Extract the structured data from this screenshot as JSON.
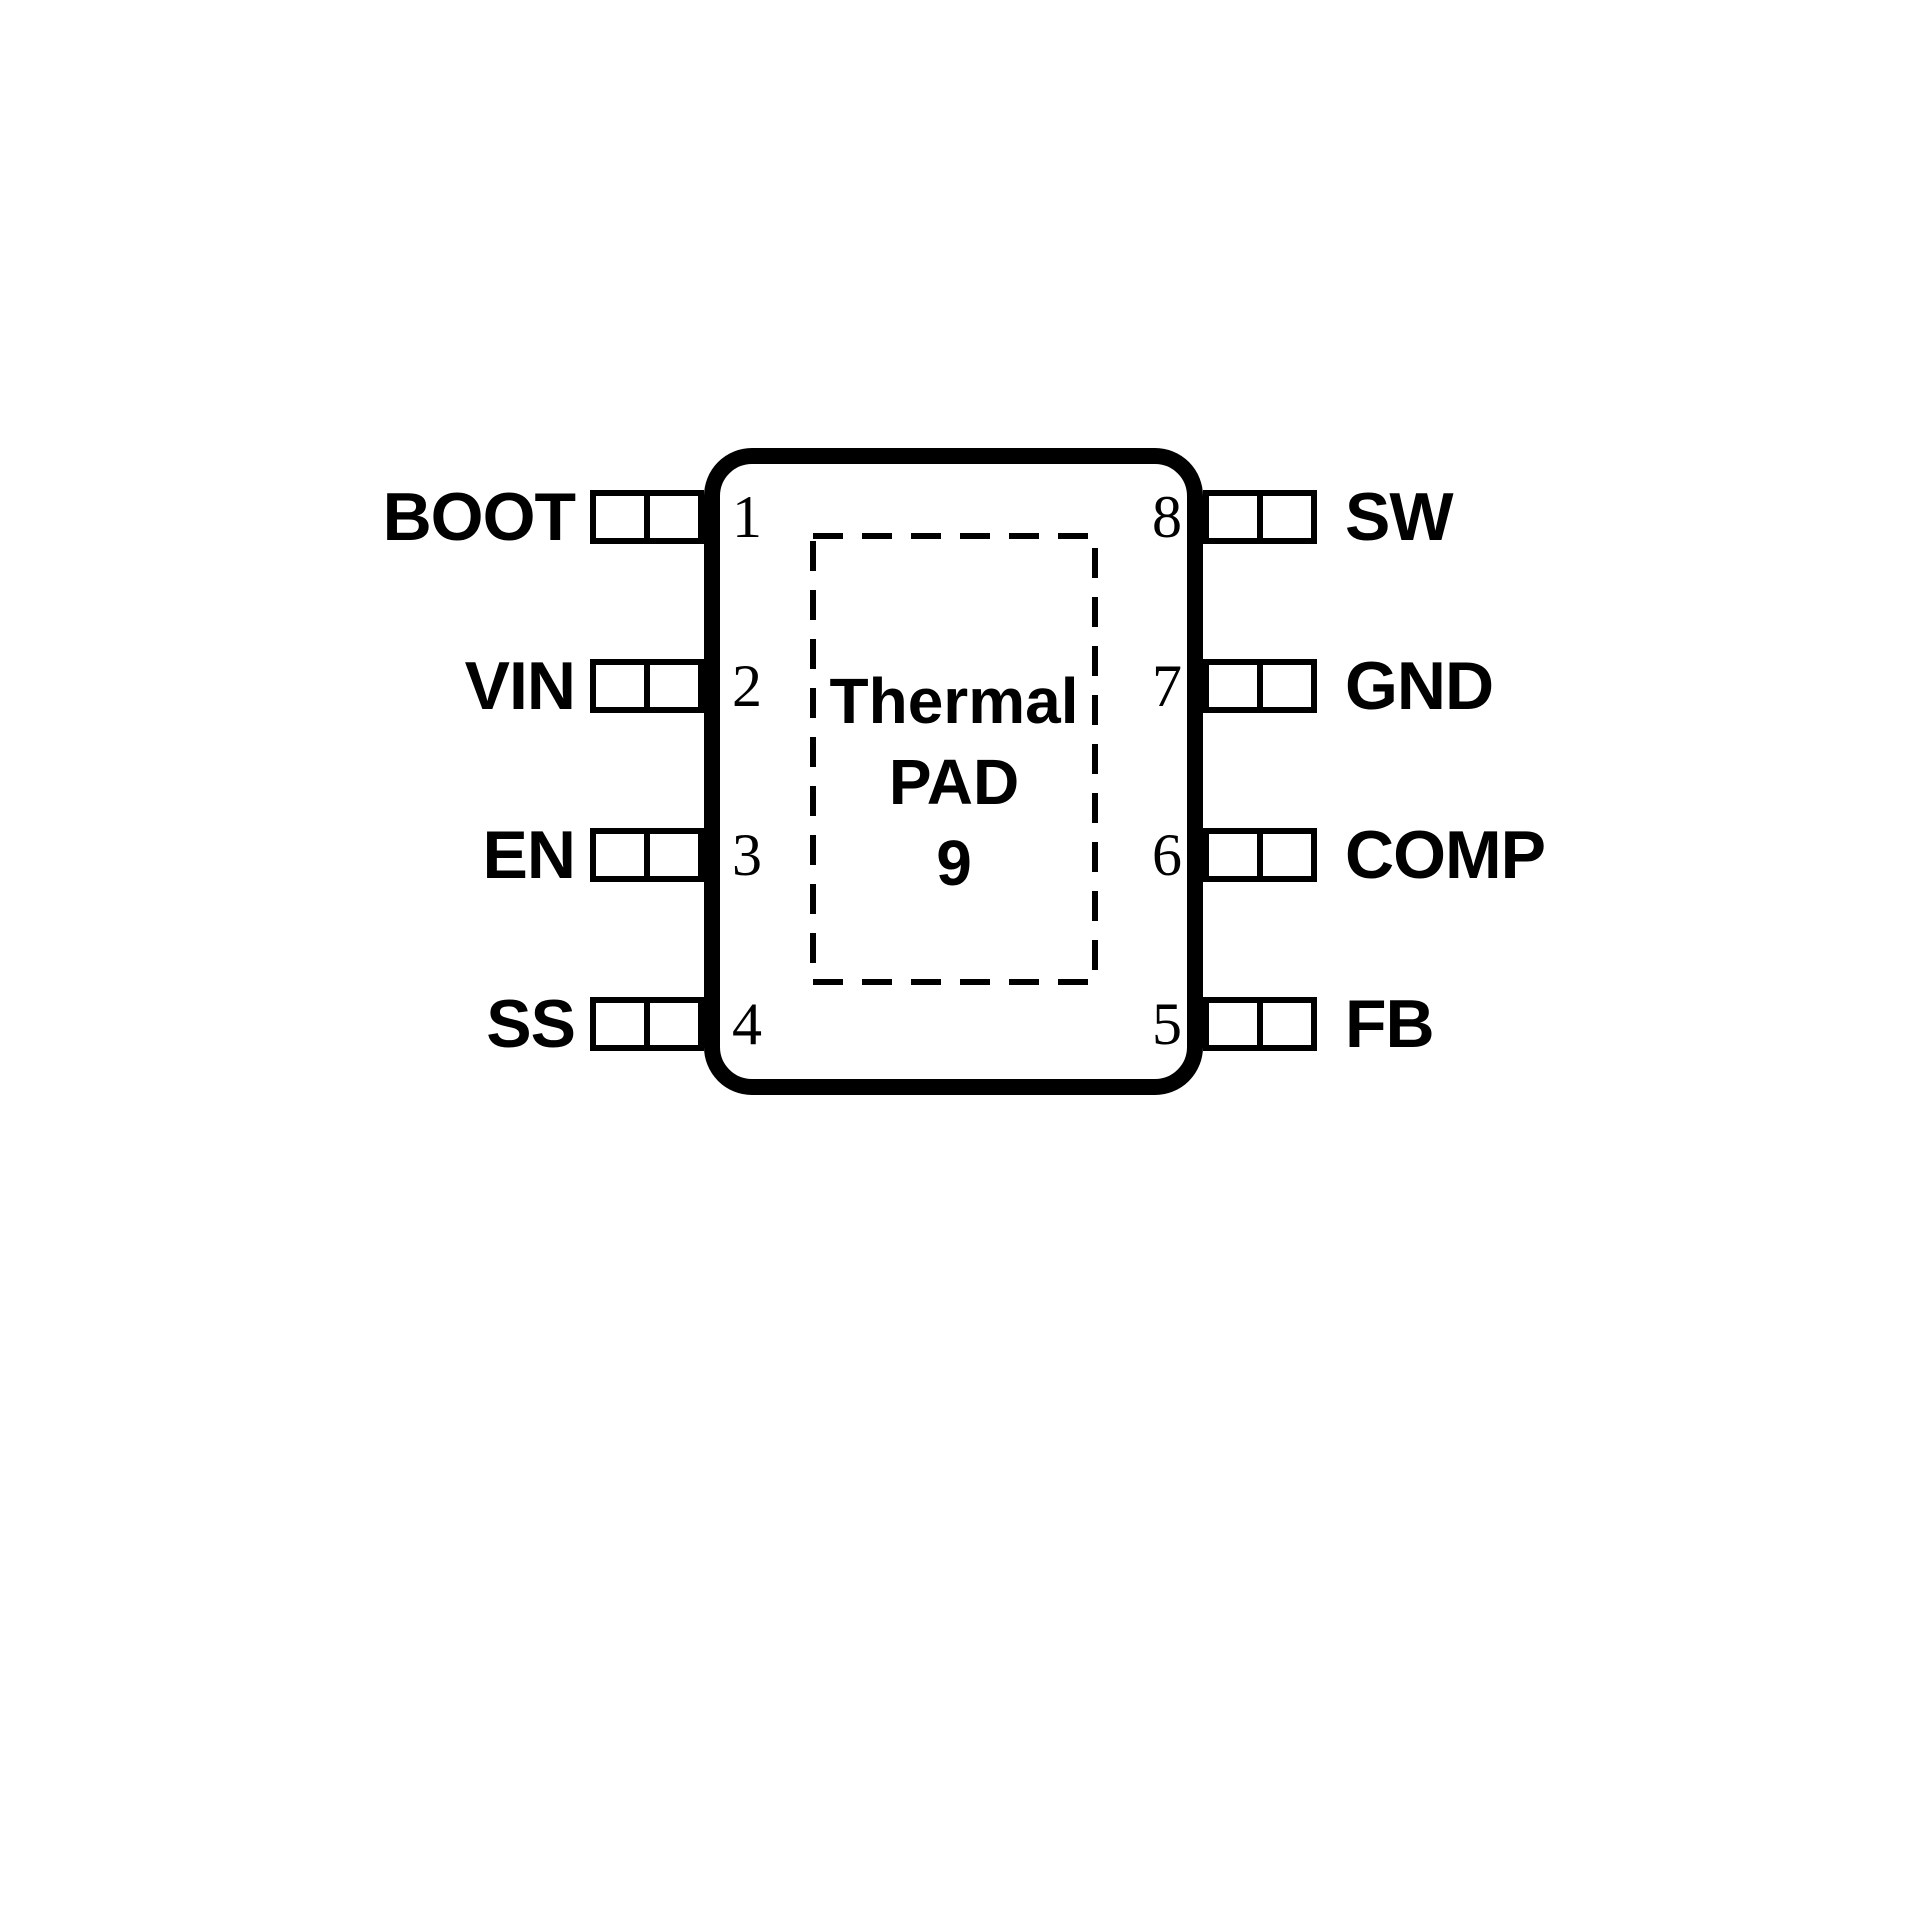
{
  "figure": {
    "type": "ic-pinout-diagram",
    "background_color": "#ffffff",
    "line_color": "#000000",
    "thermal_pad": {
      "line1": "Thermal",
      "line2": "PAD",
      "pad_number": "9"
    },
    "pins_left": [
      {
        "number": "1",
        "label": "BOOT"
      },
      {
        "number": "2",
        "label": "VIN"
      },
      {
        "number": "3",
        "label": "EN"
      },
      {
        "number": "4",
        "label": "SS"
      }
    ],
    "pins_right": [
      {
        "number": "8",
        "label": "SW"
      },
      {
        "number": "7",
        "label": "GND"
      },
      {
        "number": "6",
        "label": "COMP"
      },
      {
        "number": "5",
        "label": "FB"
      }
    ]
  }
}
